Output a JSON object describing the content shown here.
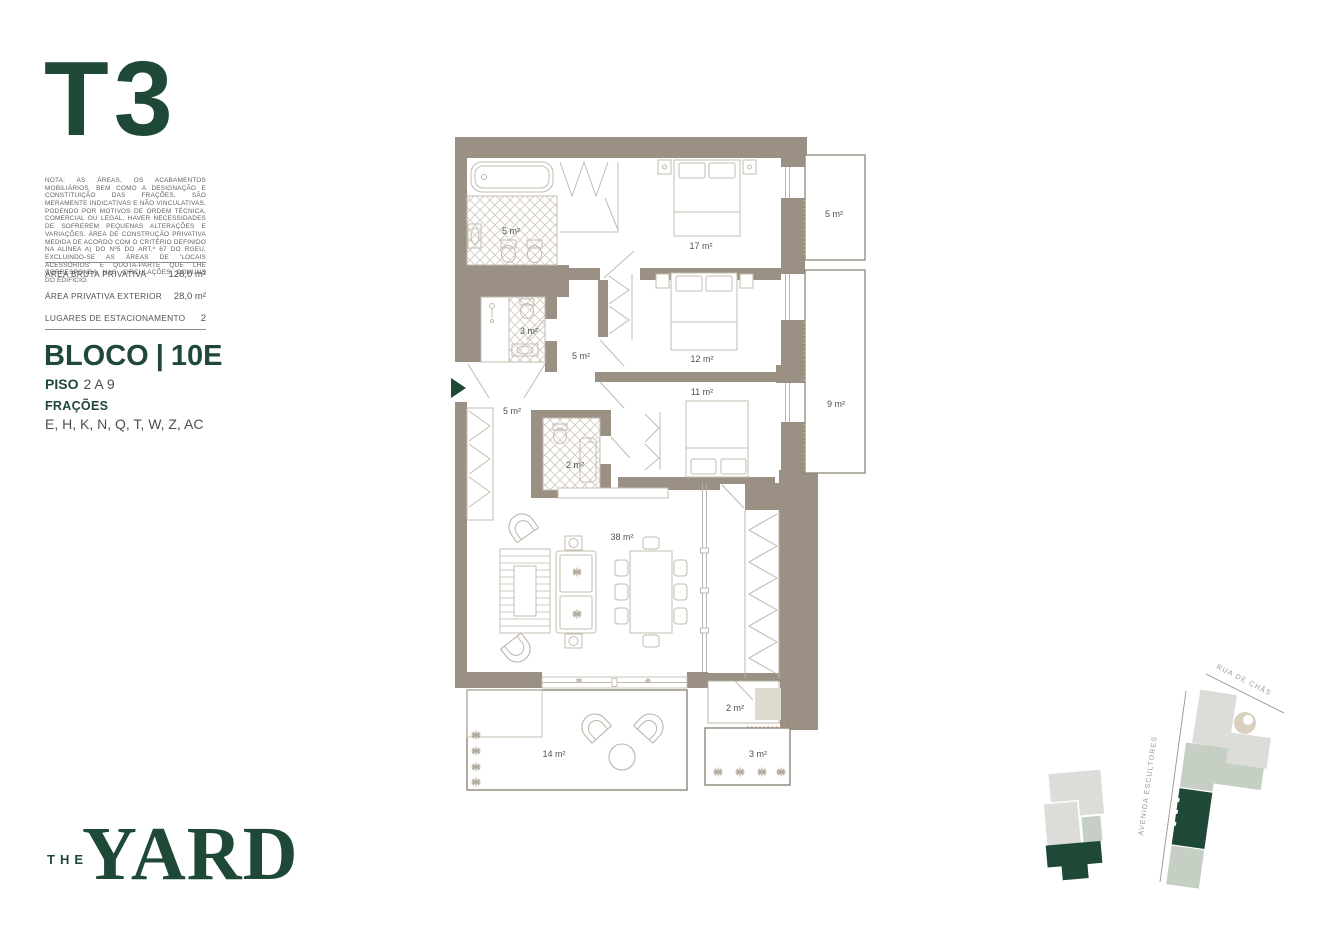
{
  "colors": {
    "brand": "#1E4937",
    "wall": "#9A9184",
    "sage": "#C5CFC4",
    "map_gray": "#DCDCD9"
  },
  "sidebar": {
    "unit_type": "T3",
    "disclaimer": "NOTA: AS ÁREAS, OS ACABAMENTOS MOBILIÁRIOS, BEM COMO A DESIGNAÇÃO E CONSTITUIÇÃO DAS FRAÇÕES, SÃO MERAMENTE INDICATIVAS E NÃO VINCULATIVAS, PODENDO POR MOTIVOS DE ORDEM TÉCNICA, COMERCIAL OU LEGAL, HAVER NECESSIDADES DE SOFREREM PEQUENAS ALTERAÇÕES E VARIAÇÕES. ÁREA DE CONSTRUÇÃO PRIVATIVA MEDIDA DE ACORDO COM O CRITÉRIO DEFINIDO NA ALÍNEA A) DO Nº5 DO ART.º 67 DO RGEU, EXCLUINDO-SE AS ÁREAS DE 'LOCAIS ACESSÓRIOS' E QUOTA-PARTE QUE LHE CORRESPONDA NAS CIRCULAÇÕES COMUNS DO EDIFÍCIO.",
    "areas": [
      {
        "label": "ÁREA BRUTA PRIVATIVA",
        "value": "128,0 m²"
      },
      {
        "label": "ÁREA PRIVATIVA EXTERIOR",
        "value": "28,0 m²"
      },
      {
        "label": "LUGARES DE ESTACIONAMENTO",
        "value": "2"
      }
    ],
    "bloco": {
      "label": "BLOCO",
      "separator": "|",
      "value": "10E"
    },
    "piso": {
      "label": "PISO",
      "value": "2 A 9"
    },
    "fracoes": {
      "label": "FRAÇÕES",
      "value": "E, H, K, N, Q, T, W, Z, AC"
    }
  },
  "floorplan": {
    "room_labels": [
      {
        "room": "bathroom-1",
        "text": "5 m²"
      },
      {
        "room": "bedroom-17",
        "text": "17 m²"
      },
      {
        "room": "balcony-5",
        "text": "5 m²"
      },
      {
        "room": "bathroom-2",
        "text": "3 m²"
      },
      {
        "room": "hall",
        "text": "5 m²"
      },
      {
        "room": "bedroom-12",
        "text": "12 m²"
      },
      {
        "room": "bedroom-11",
        "text": "11 m²"
      },
      {
        "room": "balcony-9",
        "text": "9 m²"
      },
      {
        "room": "kitchen-entry",
        "text": "5 m²"
      },
      {
        "room": "wc",
        "text": "2 m²"
      },
      {
        "room": "living-dining",
        "text": "38 m²"
      },
      {
        "room": "terrace",
        "text": "14 m²"
      },
      {
        "room": "storage",
        "text": "2 m²"
      },
      {
        "room": "balcony-3",
        "text": "3 m²"
      }
    ],
    "window_dims": [
      {
        "text": "30"
      },
      {
        "text": "41"
      }
    ]
  },
  "sitemap": {
    "street_top": "RUA DE CHÃS",
    "street_left": "AVENIDA ESCULTORES"
  },
  "logo": {
    "the": "THE",
    "yard": "YARD"
  }
}
